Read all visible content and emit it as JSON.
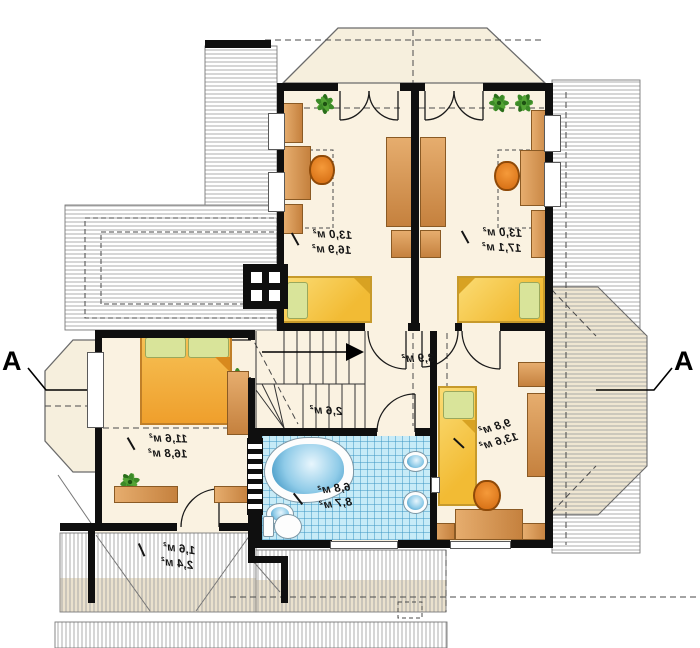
{
  "section_markers": {
    "left": "A",
    "right": "A"
  },
  "rooms": [
    {
      "name": "bedroom-top-left",
      "area_usable": "13,0 м²",
      "area_total": "16,9 м²"
    },
    {
      "name": "bedroom-top-right",
      "area_usable": "13,0 м²",
      "area_total": "17,1 м²"
    },
    {
      "name": "hallway",
      "area_usable": "3,9 м²",
      "area_total": ""
    },
    {
      "name": "staircase",
      "area_usable": "2,6 м²",
      "area_total": ""
    },
    {
      "name": "bedroom-bottom-left",
      "area_usable": "11,6 м²",
      "area_total": "16,8 м²"
    },
    {
      "name": "bathroom",
      "area_usable": "6,8 м²",
      "area_total": "8,7 м²"
    },
    {
      "name": "bedroom-bottom-right",
      "area_usable": "9,8 м²",
      "area_total": "13,6 м²"
    },
    {
      "name": "storage-under-roof",
      "area_usable": "1,6 м²",
      "area_total": "2,4 м²"
    }
  ],
  "colors": {
    "wall": "#0f0f0f",
    "floor": "#faf2e1",
    "bathroom_tile": "#c7ebf7",
    "bed_yellow": "#f2bb34",
    "bed_orange": "#ef9f2c",
    "furniture_wood": "#d29153",
    "chair_orange": "#e07a1a",
    "plant_green": "#3c8a28",
    "tub_blue": "#2c88ba"
  }
}
